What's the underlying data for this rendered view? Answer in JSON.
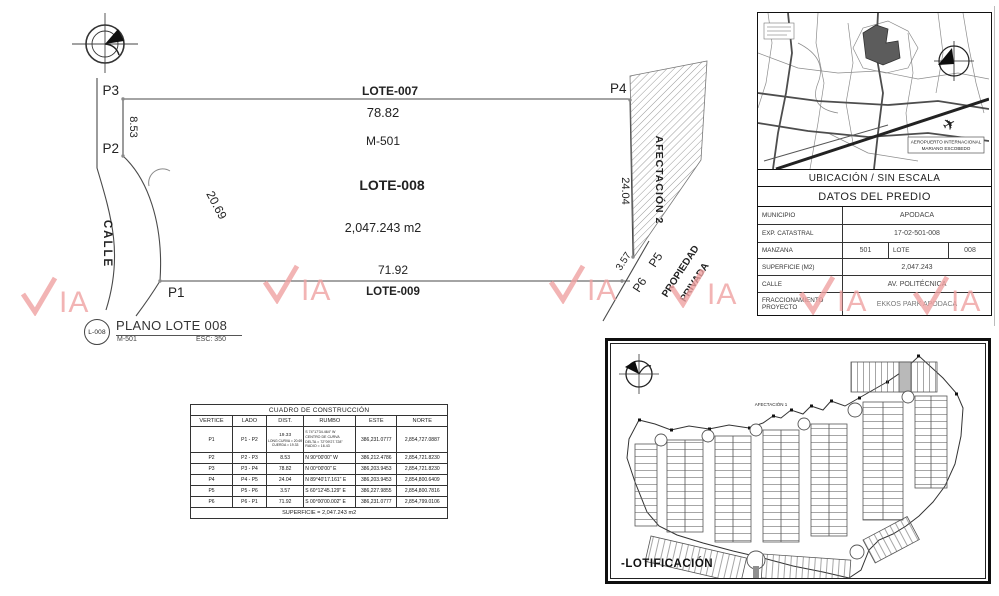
{
  "watermark": {
    "text": "VIA",
    "suffix": "IA",
    "color": "#f0a2a2"
  },
  "main_plan": {
    "points": {
      "p1": "P1",
      "p2": "P2",
      "p3": "P3",
      "p4": "P4",
      "p5": "P5",
      "p6": "P6"
    },
    "labels": {
      "lote_top": "LOTE-007",
      "dim_top": "78.82",
      "manzana": "M-501",
      "lote_main": "LOTE-008",
      "area": "2,047.243 m2",
      "dim_bottom": "71.92",
      "lote_bottom": "LOTE-009",
      "dim_left": "8.53",
      "dim_curve": "20.69",
      "dim_right": "24.04",
      "dim_diag": "3.57",
      "calle": "CALLE",
      "afectacion": "AFECTACIÓN 2",
      "propiedad_1": "PROPIEDAD",
      "propiedad_2": "PRIVADA"
    },
    "title_block": {
      "ref": "L-008",
      "title": "PLANO LOTE 008",
      "manzana": "M-501",
      "escala": "ESC: 350"
    }
  },
  "construction_table": {
    "title": "CUADRO DE CONSTRUCCIÓN",
    "headers": [
      "VERTICE",
      "LADO",
      "DIST.",
      "RUMBO",
      "ESTE",
      "NORTE"
    ],
    "rows": [
      {
        "v": "P1",
        "lado": "P1   -   P2",
        "dist": "19.33",
        "dist_sub1": "LONG CURVA = 20.69",
        "dist_sub2": "CUERDA = 19.33",
        "rumbo1": "S 74°17'34.464\" W",
        "rumbo2": "CENTRO DE CURVA",
        "rumbo3": "DELTA = 72°09'27.728\"",
        "rumbo4": "RADIO = 16.43",
        "este": "386,231.0777",
        "norte": "2,854,727.0887"
      },
      {
        "v": "P2",
        "lado": "P2   -   P3",
        "dist": "8.53",
        "rumbo1": "N 90°00'00\" W",
        "este": "386,212.4786",
        "norte": "2,854,721.8230"
      },
      {
        "v": "P3",
        "lado": "P3   -   P4",
        "dist": "78.82",
        "rumbo1": "N 00°00'00\" E",
        "este": "386,203.9453",
        "norte": "2,854,721.8230"
      },
      {
        "v": "P4",
        "lado": "P4   -   P5",
        "dist": "24.04",
        "rumbo1": "N 89°40'17.161\" E",
        "este": "386,203.9453",
        "norte": "2,854,800.6409"
      },
      {
        "v": "P5",
        "lado": "P5   -   P6",
        "dist": "3.57",
        "rumbo1": "S 60°12'45.129\" E",
        "este": "386,227.9855",
        "norte": "2,854,800.7816"
      },
      {
        "v": "P6",
        "lado": "P6   -   P1",
        "dist": "71.92",
        "rumbo1": "S 00°00'00.002\" E",
        "este": "386,231.0777",
        "norte": "2,854,799.0106"
      }
    ],
    "footer": "SUPERFICIE = 2,047.243 m2"
  },
  "location_panel": {
    "map_caption": "UBICACIÓN / SIN ESCALA",
    "airport_line1": "AEROPUERTO INTERNACIONAL",
    "airport_line2": "MARIANO ESCOBEDO",
    "datos": {
      "title": "DATOS DEL PREDIO",
      "rows": [
        {
          "label": "MUNICIPIO",
          "value": "APODACA"
        },
        {
          "label": "EXP. CATASTRAL",
          "value": "17-02-501-008"
        },
        {
          "label": "MANZANA",
          "value": "501",
          "label2": "LOTE",
          "value2": "008"
        },
        {
          "label": "SUPERFICIE (M2)",
          "value": "2,047.243"
        },
        {
          "label": "CALLE",
          "value": "AV. POLITÉCNICA"
        },
        {
          "label": "FRACCIONAMIENTO PROYECTO",
          "value": "EKKOS PARK APODACA"
        }
      ]
    }
  },
  "lotification_panel": {
    "caption": "-LOTIFICACIÓN",
    "afectacion_label": "AFECTACIÓN 1"
  }
}
